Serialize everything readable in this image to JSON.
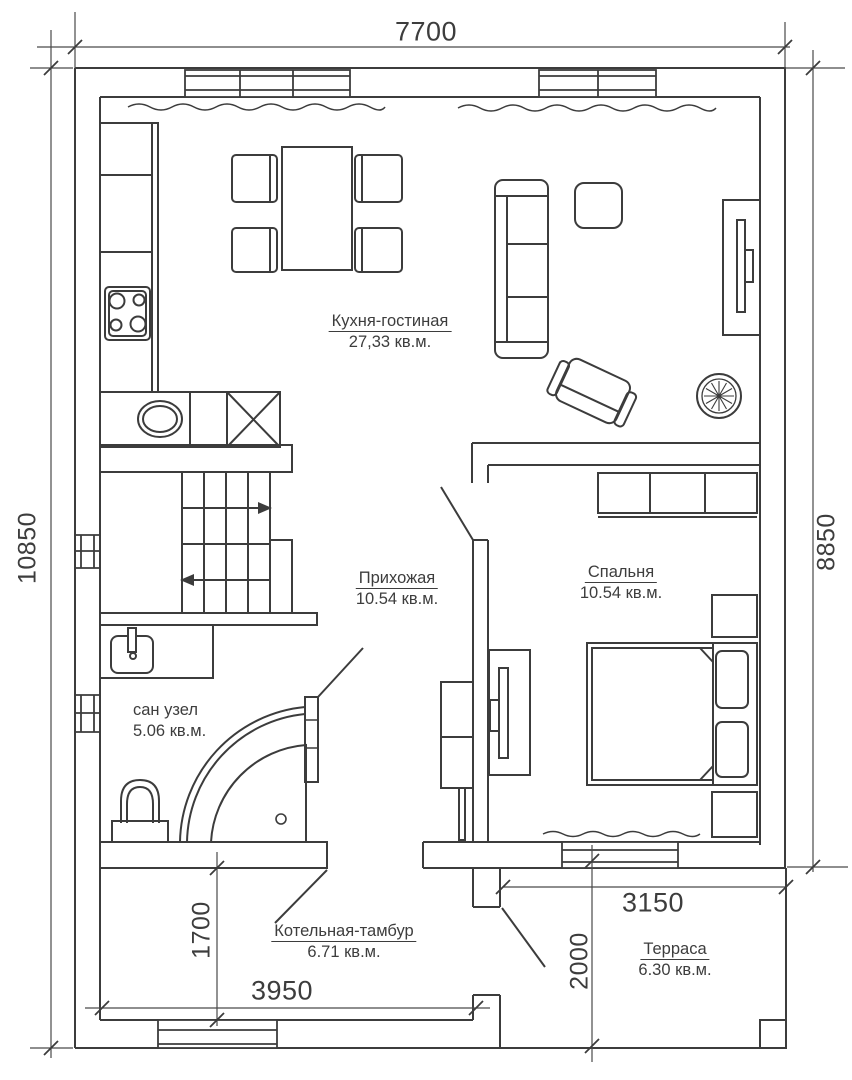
{
  "rooms": {
    "kitchen_living": {
      "name": "Кухня-гостиная",
      "area": "27,33 кв.м."
    },
    "hallway": {
      "name": "Прихожая",
      "area": "10.54 кв.м."
    },
    "bedroom": {
      "name": "Спальня",
      "area": "10.54 кв.м."
    },
    "bathroom": {
      "name": "сан узел",
      "area": "5.06 кв.м."
    },
    "boiler_room": {
      "name": "Котельная-тамбур",
      "area": "6.71 кв.м."
    },
    "terrace": {
      "name": "Терраса",
      "area": "6.30 кв.м."
    }
  },
  "dimensions": {
    "top_width": "7700",
    "left_height": "10850",
    "right_height": "8850",
    "boiler_width": "3950",
    "boiler_height": "1700",
    "terrace_width": "3150",
    "terrace_height": "2000"
  },
  "colors": {
    "line": "#3c3c3c",
    "text": "#3d3d3d",
    "background": "#ffffff"
  }
}
